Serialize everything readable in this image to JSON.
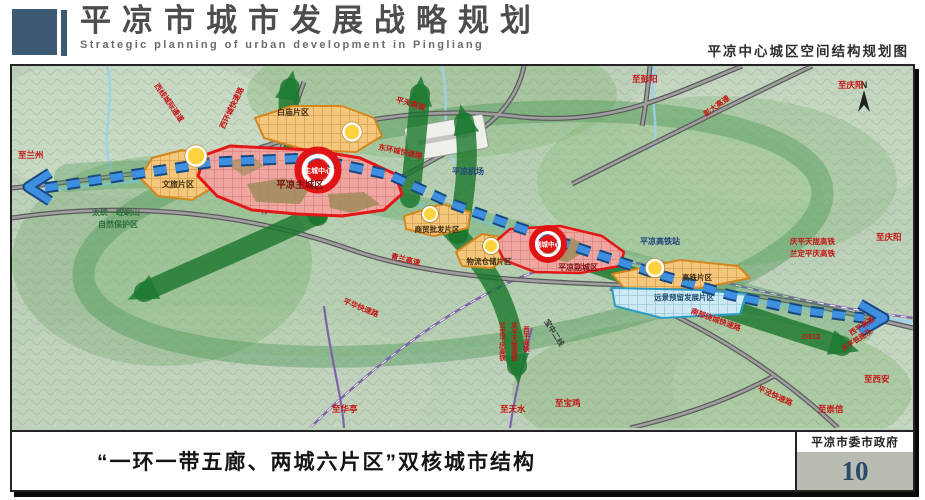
{
  "header": {
    "title": "平凉市城市发展战略规划",
    "subtitle": "Strategic planning of urban development in Pingliang",
    "map_title": "平凉中心城区空间结构规划图"
  },
  "footer": {
    "caption": "“一环一带五廊、两城六片区”双核城市结构",
    "agency": "平凉市委市政府",
    "page_number": "10"
  },
  "colors": {
    "brand_slate": "#3d5a74",
    "urban_red": "#e21717",
    "district_orange": "#d4861f",
    "reserve_blue": "#2a9cc4",
    "belt_blue": "#3f8fe0",
    "corridor_green": "#1d7a33",
    "road_label_red": "#c51414"
  },
  "map": {
    "compass": "N",
    "cores": {
      "main": "主城中心",
      "sub": "副城中心"
    },
    "cities": {
      "main": "平凉主城区",
      "sub": "平凉副城区"
    },
    "districts": {
      "wenlv": "文旅片区",
      "baimiao": "白庙片区",
      "shangmao": "商贸批发片区",
      "wuliu": "物流仓储片区",
      "gaotie": "高铁片区",
      "yuanjing": "远景预留发展片区"
    },
    "labels": {
      "to_lanzhou": "至兰州",
      "nature_reserve_1": "太统—崆峒山",
      "nature_reserve_2": "自然保护区",
      "west_corridor": "西线城际通道",
      "west_ring": "西环城快速路",
      "east_ring": "东环城快速路",
      "pingtian_expwy": "平天高速",
      "airport": "平凉机场",
      "to_pengyang": "至彭阳",
      "pengda_expwy": "彭大高速",
      "to_qingyang_top": "至庆阳",
      "qinglan_expwy": "青兰高速",
      "hsr_station": "平凉高铁站",
      "qptl_hsr": "庆平天陇高铁",
      "ldpq_hsr": "兰定平庆高铁",
      "xiping_hsr": "西平高铁",
      "to_qingyang_right": "至庆阳",
      "south_ring": "南部绕城快速路",
      "g312": "G312",
      "xiping_expwy": "西平高速",
      "tianping_rail": "天平铁路及",
      "to_xian": "至西安",
      "to_chongxin": "至崇信",
      "pingjing_expwy": "平泾快速路",
      "to_huating": "至华亭",
      "pinghua_expwy": "平华快速路",
      "to_tianshui": "至天水",
      "to_baoji": "至宝鸡",
      "baozhong_line": "宝中二线"
    }
  }
}
